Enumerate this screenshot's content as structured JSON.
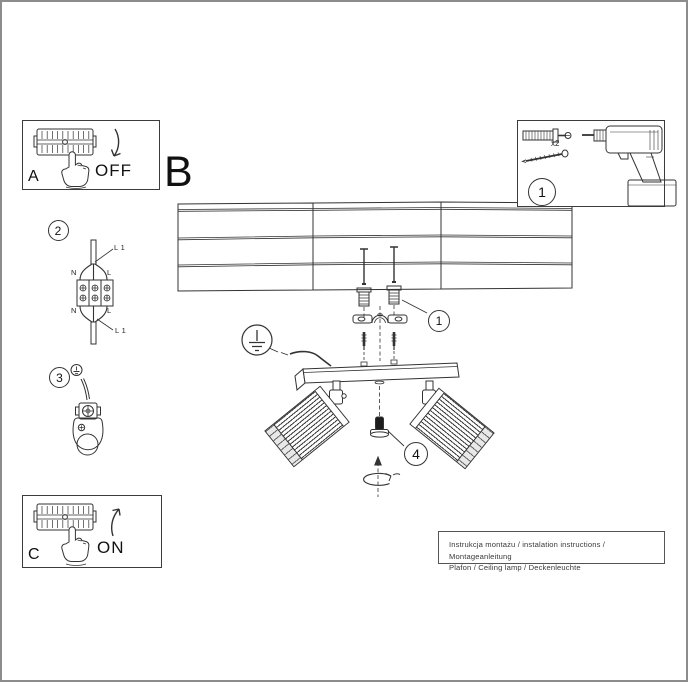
{
  "panel_a": {
    "label": "A",
    "state": "OFF"
  },
  "section_b": {
    "label": "B"
  },
  "panel_c": {
    "label": "C",
    "state": "ON"
  },
  "tools": {
    "step": "1",
    "quantity": "x2"
  },
  "steps": {
    "mounting": "1",
    "wiring": "2",
    "earth": "3",
    "knob": "4"
  },
  "wiring_labels": {
    "l1_top": "L 1",
    "n_top": "N",
    "l_top": "L",
    "n_bottom": "N",
    "l_bottom": "L",
    "l1_bottom": "L 1"
  },
  "footer": {
    "line1": "Instrukcja montażu / instalation instructions / Montageanleitung",
    "line2": "Plafon / Ceiling lamp / Deckenleuchte"
  }
}
